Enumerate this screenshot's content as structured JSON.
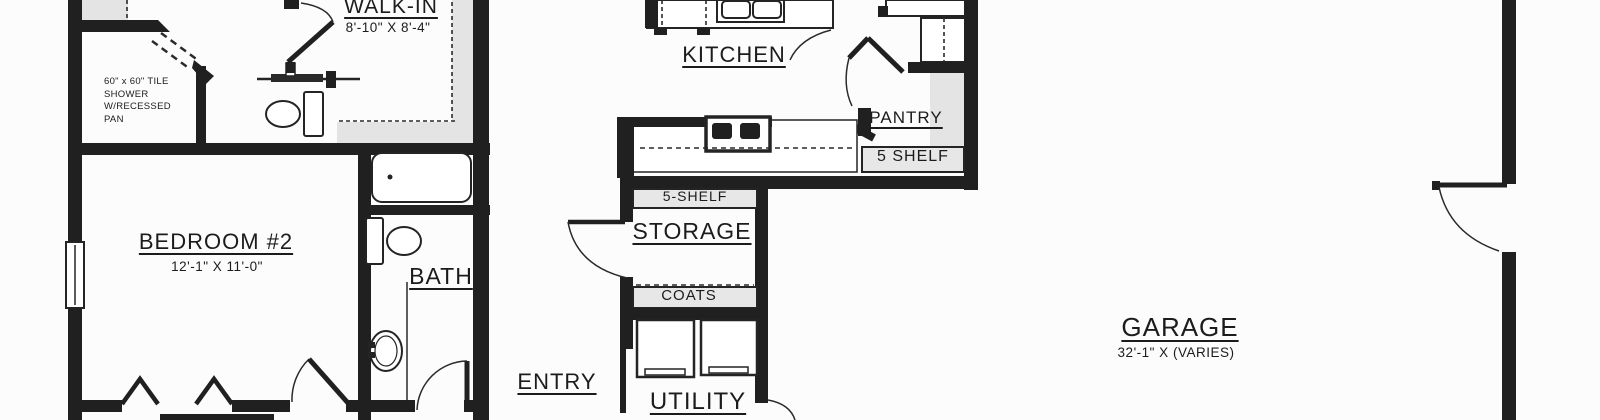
{
  "colors": {
    "wall": "#202020",
    "background": "#fcfcfc",
    "shelf_fill": "#e4e4e4",
    "text": "#1c1c1c"
  },
  "rooms": {
    "walk_in": {
      "label": "WALK-IN",
      "dims": "8'-10\" X 8'-4\""
    },
    "kitchen": {
      "label": "KITCHEN"
    },
    "pantry": {
      "label": "PANTRY",
      "shelf_label": "5 SHELF"
    },
    "storage": {
      "label": "STORAGE",
      "shelf_label": "5-SHELF",
      "coats_label": "COATS"
    },
    "bedroom_2": {
      "label": "BEDROOM #2",
      "dims": "12'-1\" X 11'-0\""
    },
    "bath": {
      "label": "BATH"
    },
    "entry": {
      "label": "ENTRY"
    },
    "utility": {
      "label": "UTILITY"
    },
    "garage": {
      "label": "GARAGE",
      "dims": "32'-1\" X (VARIES)"
    }
  },
  "annotations": {
    "shower_note": "60\" x 60\" TILE\nSHOWER\nW/RECESSED\nPAN"
  }
}
